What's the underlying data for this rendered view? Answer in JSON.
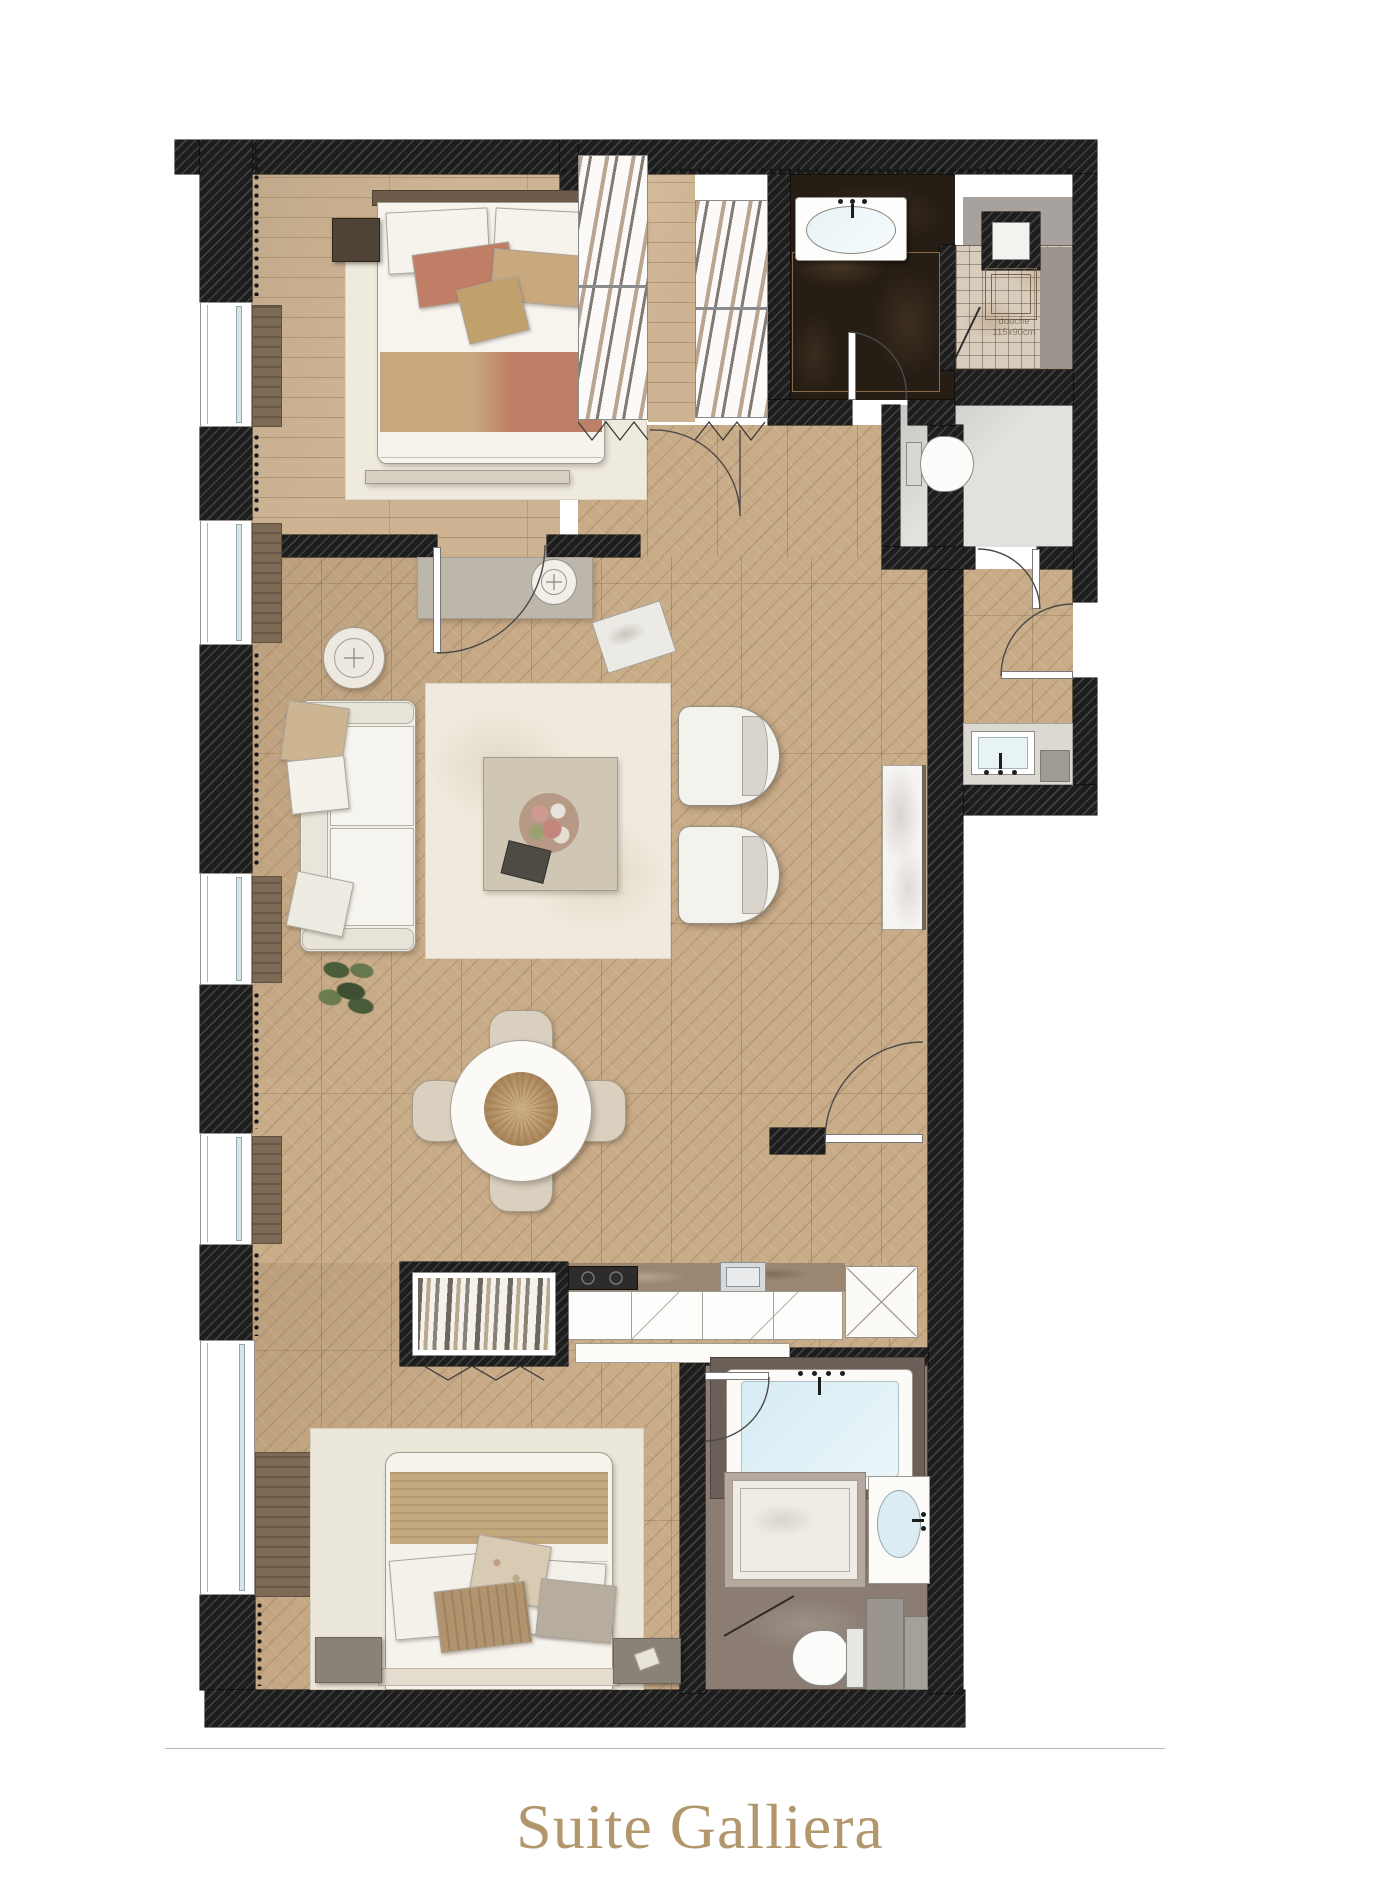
{
  "page": {
    "title": "Suite Galliera"
  },
  "plan": {
    "shower_label_line1": "douche",
    "shower_label_line2": "115x90cm"
  },
  "colors": {
    "wall": "#1d1d1d",
    "wood": "#cdb391",
    "chevron": "#c8ab87",
    "cream": "#efeade",
    "terracotta": "#bf7e65",
    "tan": "#c9a87e",
    "curtain": "#7d6a55",
    "nightstand": "#4f4236",
    "marble_dark": "#261d15",
    "marble_gray": "#8b7d73",
    "water": "#d7ecf4",
    "title": "#b3976c"
  }
}
